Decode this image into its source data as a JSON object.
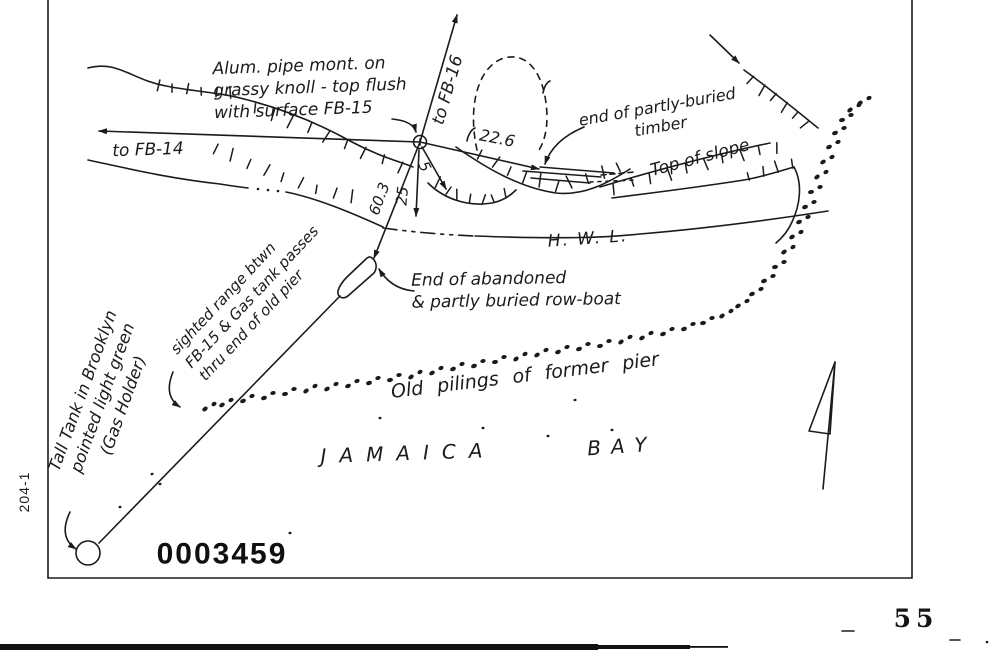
{
  "sketch": {
    "ink_color": "#1b1b1b",
    "station_note": "Alum. pipe mont. on\ngrassy knoll - top flush\nwith surface FB-15",
    "to_fb16": "to FB-16",
    "to_fb14": "to FB-14",
    "dist_timber": "22.6",
    "dist_short": "5",
    "dist_hwl": "25",
    "dist_rowboat": "60.3",
    "timber_note": "end of partly-buried\ntimber",
    "top_of_slope": "Top of slope",
    "hwl": "H. W. L.",
    "rowboat_note": "End of abandoned\n& partly buried row-boat",
    "sighted_range_note": "sighted range btwn\nFB-15 & Gas tank passes\nthru end of old pier",
    "old_pilings": "Old pilings of former pier",
    "bay_word1": "JAMAICA",
    "bay_word2": "BAY",
    "gas_tank_note": "Tall Tank in Brooklyn\npointed light green\n(Gas Holder)",
    "margin_label": "204-1",
    "stamp_number": "0003459",
    "page_number": "55"
  }
}
